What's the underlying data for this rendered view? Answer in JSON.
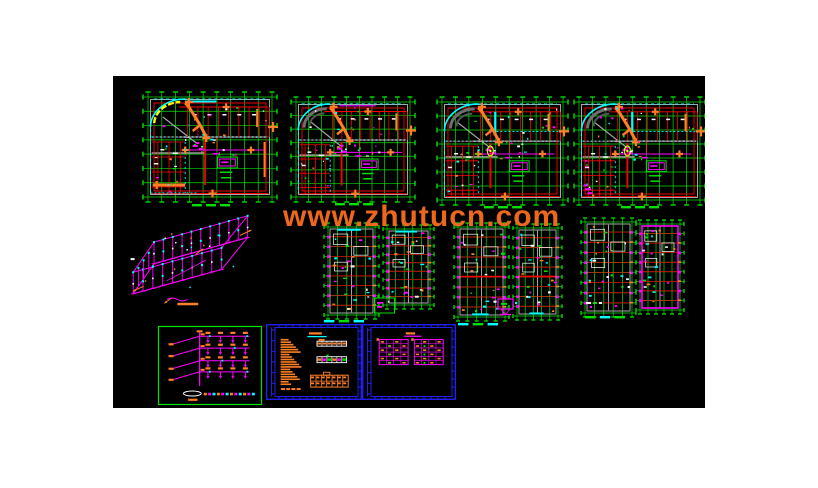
{
  "meta": {
    "description": "CAD drawing sheet preview: four floor plans, axonometric wiring diagram, six unit-plan strips, riser tree diagram and two framed note/legend sheets on a black model-space background",
    "page_bg": "#ffffff",
    "canvas_bg": "#000000"
  },
  "canvas": {
    "x": 113,
    "y": 76,
    "w": 592,
    "h": 332
  },
  "watermark": {
    "text": "www.zhutucn.com",
    "color": "#ed671c",
    "x": 283,
    "y": 202,
    "font_size": 30
  },
  "palette": {
    "green": "#00e100",
    "red": "#ff0000",
    "cyan": "#00ffff",
    "magenta": "#ff00ff",
    "orange": "#ff7f27",
    "gray": "#a8a8a8",
    "dgray": "#6e6e6e",
    "white": "#ffffff",
    "blue": "#2222ff",
    "yellow": "#ffff00",
    "ygreen": "#c8ff00"
  },
  "blocks": [
    {
      "id": "floor-plan-1",
      "type": "floorplan",
      "x": 148,
      "y": 97,
      "w": 124,
      "h": 100,
      "variant": 1
    },
    {
      "id": "floor-plan-2",
      "type": "floorplan",
      "x": 296,
      "y": 102,
      "w": 114,
      "h": 95,
      "variant": 2
    },
    {
      "id": "floor-plan-3",
      "type": "floorplan",
      "x": 442,
      "y": 102,
      "w": 121,
      "h": 98,
      "variant": 3
    },
    {
      "id": "floor-plan-4",
      "type": "floorplan",
      "x": 579,
      "y": 102,
      "w": 121,
      "h": 98,
      "variant": 4
    },
    {
      "id": "axonometric-wiring-diagram",
      "type": "axon",
      "x": 128,
      "y": 213,
      "w": 130,
      "h": 94
    },
    {
      "id": "unit-strip-a1",
      "type": "strip",
      "x": 328,
      "y": 227,
      "w": 47,
      "h": 88,
      "variant": 1
    },
    {
      "id": "unit-strip-a2",
      "type": "strip",
      "x": 387,
      "y": 229,
      "w": 43,
      "h": 76,
      "variant": 2
    },
    {
      "id": "unit-strip-b1",
      "type": "strip",
      "x": 458,
      "y": 227,
      "w": 47,
      "h": 90,
      "variant": 3
    },
    {
      "id": "unit-strip-b2",
      "type": "strip",
      "x": 517,
      "y": 228,
      "w": 41,
      "h": 88,
      "variant": 4
    },
    {
      "id": "unit-strip-c1",
      "type": "strip",
      "x": 585,
      "y": 222,
      "w": 47,
      "h": 91,
      "variant": 5
    },
    {
      "id": "unit-strip-c2",
      "type": "strip",
      "x": 640,
      "y": 224,
      "w": 40,
      "h": 86,
      "variant": 6
    },
    {
      "id": "riser-tree-diagram",
      "type": "tree",
      "x": 158,
      "y": 326,
      "w": 104,
      "h": 79
    },
    {
      "id": "notes-sheet",
      "type": "sheet",
      "x": 266,
      "y": 324,
      "w": 96,
      "h": 76,
      "variant": 1
    },
    {
      "id": "legend-sheet",
      "type": "sheet",
      "x": 362,
      "y": 324,
      "w": 94,
      "h": 76,
      "variant": 2
    },
    {
      "id": "mini-detail-box",
      "type": "minibox",
      "x": 374,
      "y": 296,
      "w": 21,
      "h": 18
    },
    {
      "id": "monitor-symbol",
      "type": "monitor",
      "x": 497,
      "y": 299,
      "w": 24,
      "h": 18
    },
    {
      "id": "detail-mark-c",
      "type": "markrow",
      "x": 586,
      "y": 300,
      "w": 18,
      "h": 9
    },
    {
      "id": "plan-1-title",
      "type": "titledash",
      "x": 192,
      "y": 203,
      "w": 38,
      "h": 4,
      "colors": [
        "#00e100"
      ]
    },
    {
      "id": "plan-2-title",
      "type": "titledash",
      "x": 335,
      "y": 202,
      "w": 38,
      "h": 4,
      "colors": [
        "#00e100"
      ]
    },
    {
      "id": "plan-3-title",
      "type": "titledash",
      "x": 484,
      "y": 205,
      "w": 38,
      "h": 4,
      "colors": [
        "#00e100"
      ]
    },
    {
      "id": "plan-4-title",
      "type": "titledash",
      "x": 621,
      "y": 205,
      "w": 38,
      "h": 4,
      "colors": [
        "#00e100"
      ]
    },
    {
      "id": "strips-a-title",
      "type": "titledash",
      "x": 324,
      "y": 319,
      "w": 40,
      "h": 4,
      "colors": [
        "#00ffff",
        "#00e100"
      ]
    },
    {
      "id": "strips-b-title",
      "type": "titledash",
      "x": 458,
      "y": 322,
      "w": 40,
      "h": 4,
      "colors": [
        "#00ffff",
        "#00e100"
      ]
    },
    {
      "id": "strips-c-title",
      "type": "titledash",
      "x": 585,
      "y": 315,
      "w": 40,
      "h": 4,
      "colors": [
        "#00e100",
        "#00ffff"
      ]
    }
  ]
}
